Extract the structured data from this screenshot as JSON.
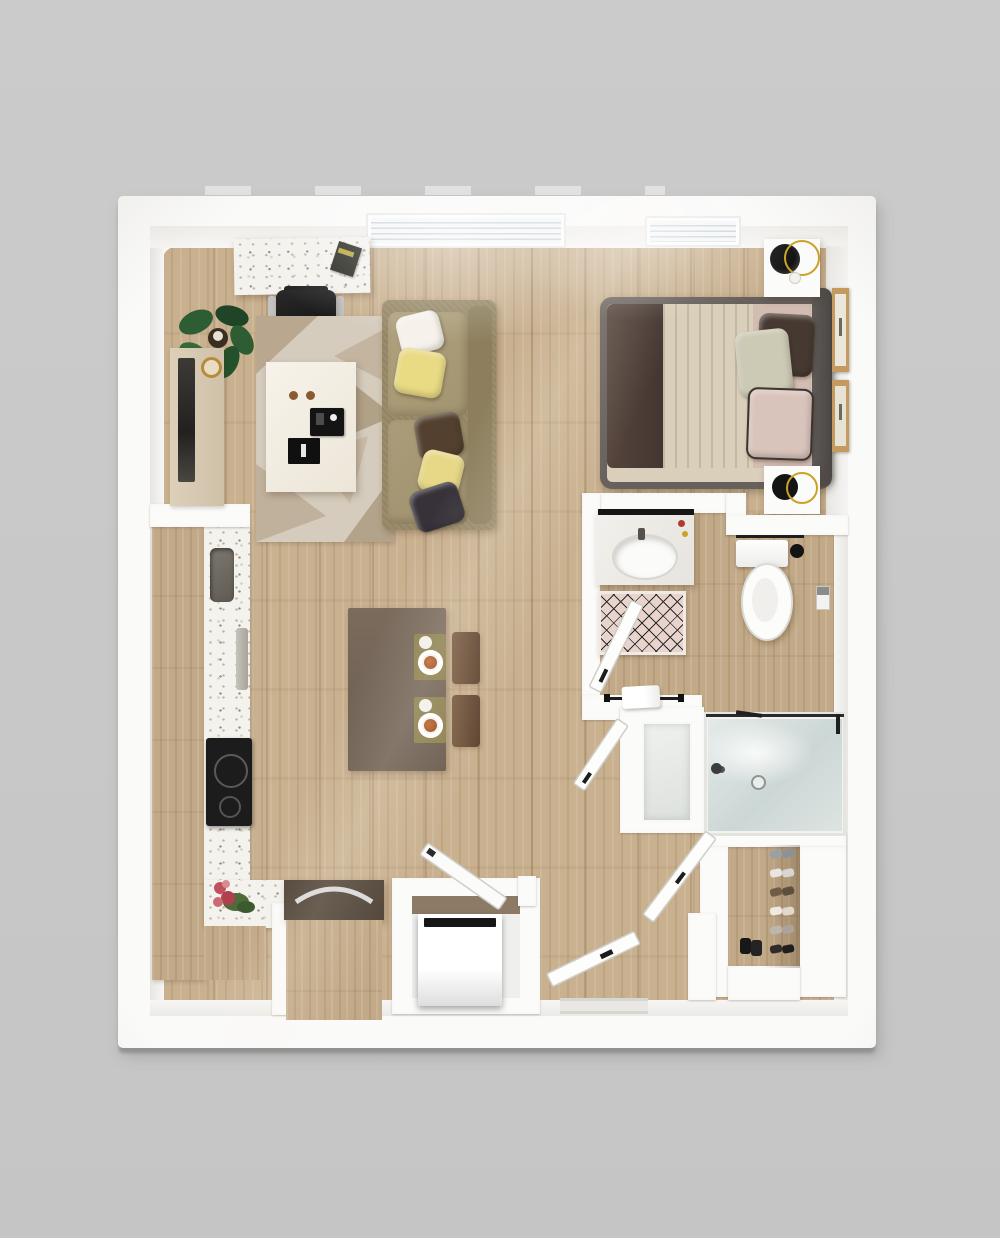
{
  "scene": {
    "kind": "3d-rendered apartment floor plan, top-down view",
    "background_color": "#c8c8c8",
    "outer_wall_color": "#fafaf9",
    "drop_shadow_color": "#b6b6b6",
    "wood_floor_color": "#c9b190",
    "bathroom_floor_color": "#c2a987"
  },
  "rooms": {
    "living_dining": {
      "items": [
        "terrazzo-desk",
        "notebook",
        "office-chair",
        "potted-plant",
        "tv-console",
        "television",
        "gold-bowl",
        "geometric-rug",
        "coffee-table",
        "espresso-cups",
        "serving-tray",
        "book",
        "sofa",
        "throw-pillows",
        "dining-table",
        "place-settings",
        "dining-chairs"
      ]
    },
    "kitchen": {
      "items": [
        "cabinet-run",
        "terrazzo-countertop",
        "sink",
        "cutting-board",
        "cooktop",
        "flower-bouquet",
        "island-cabinet",
        "appliance-niche",
        "laundry-appliance",
        "niche-door"
      ]
    },
    "bedroom": {
      "items": [
        "double-bed",
        "headboard",
        "foot-blanket",
        "duvet",
        "sheet",
        "pillow-brown",
        "pillow-sage",
        "pillow-pink",
        "nightstand-top",
        "nightstand-bottom",
        "alarm-clock",
        "wall-art-frame-1",
        "wall-art-frame-2"
      ]
    },
    "bathroom": {
      "items": [
        "vanity-sink",
        "mirror-strip",
        "bath-mat",
        "bathroom-door",
        "toilet",
        "towel-bar",
        "toilet-brush",
        "toilet-paper-holder",
        "bathtub",
        "linen-panel",
        "hand-towel",
        "second-door"
      ]
    },
    "closet": {
      "items": [
        "shoe-shelf",
        "shoes",
        "closet-door"
      ]
    },
    "entry": {
      "items": [
        "entry-door",
        "door-mat"
      ]
    },
    "windows": {
      "count": 2
    }
  },
  "palette": {
    "sofa": "#a0926e",
    "pillow_white": "#f6f1ea",
    "pillow_yellow": "#e9da84",
    "pillow_brown": "#53402f",
    "pillow_dark": "#37323a",
    "rug_base": "#d5ccbd",
    "rug_triangle": "#b3a38a",
    "coffee_table": "#f4efe6",
    "dining_table": "#6f6154",
    "dining_chair": "#6b4f38",
    "placemat": "#8d8150",
    "bed_frame": "#67605c",
    "bed_blanket": "#4a3b34",
    "bed_duvet": "#d9cfba",
    "bed_sheet": "#d3bcb2",
    "headboard": "#55504d",
    "frame_wood": "#c49a5f",
    "cooktop": "#1c1c1c",
    "sink": "#6f6a62",
    "island_top": "#4f4236",
    "tub_water": "#cfdad7",
    "bath_mat": "#e8d4cd",
    "plant_leaf": "#2e5c33",
    "flowers": "#c2505c",
    "clock": "#141414",
    "clock_ring_gold": "#c9a227"
  }
}
